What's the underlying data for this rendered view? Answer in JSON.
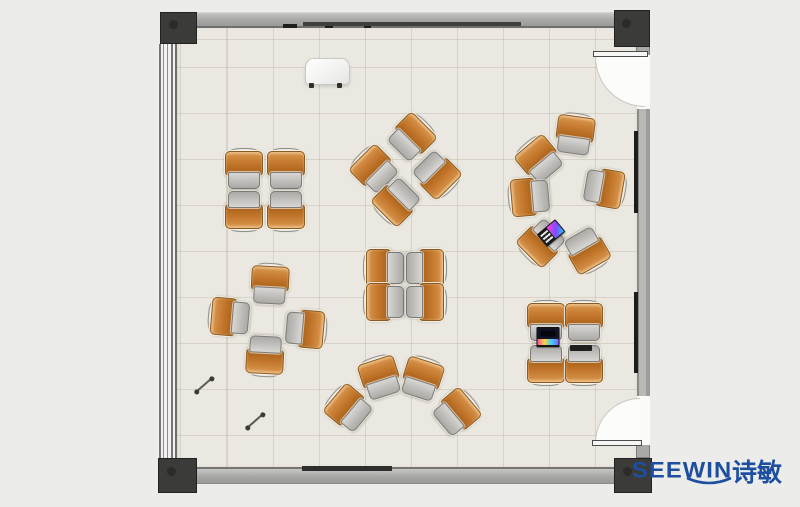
{
  "brand": {
    "latin": "SEEWIN",
    "cjk": "诗敏",
    "color": "#1d4e9f"
  },
  "palette": {
    "background": "#ececea",
    "floor": "#eae8e0",
    "floor_grid": "#d8d2c4",
    "wall": "#a6a6a4",
    "corner_post": "#3b3b39",
    "chair_seat_orange": "#c07429",
    "desk_tablet_gray": "#bdbbb7",
    "door_swing": "#fcfcfa",
    "laptop_screen_gradient": [
      "#ff3fd8",
      "#7c4dff",
      "#27c4ff"
    ]
  },
  "floorplan": {
    "description": "Top-view classroom floor plan with 30 tablet-arm chairs in 7 clusters, two doors on the right wall, window wall on the left, mobile whiteboard at top.",
    "clusters": [
      {
        "id": "top-left-quad",
        "units": [
          [
            244,
            169,
            0
          ],
          [
            286,
            169,
            0
          ],
          [
            244,
            211,
            180
          ],
          [
            286,
            211,
            180
          ]
        ]
      },
      {
        "id": "top-center-diamond",
        "units": [
          [
            374,
            169,
            -45
          ],
          [
            412,
            137,
            45
          ],
          [
            437,
            175,
            135
          ],
          [
            396,
            202,
            -135
          ]
        ]
      },
      {
        "id": "right-circle",
        "units": [
          [
            575,
            134,
            8
          ],
          [
            539,
            159,
            -40
          ],
          [
            529,
            197,
            -95
          ],
          [
            541,
            243,
            -135
          ],
          [
            605,
            188,
            100
          ],
          [
            587,
            251,
            150
          ]
        ]
      },
      {
        "id": "left-cross",
        "units": [
          [
            270,
            284,
            3
          ],
          [
            229,
            317,
            -85
          ],
          [
            306,
            329,
            95
          ],
          [
            265,
            356,
            183
          ]
        ]
      },
      {
        "id": "center-quad",
        "units": [
          [
            384,
            268,
            -90
          ],
          [
            426,
            268,
            90
          ],
          [
            384,
            302,
            -90
          ],
          [
            426,
            302,
            90
          ]
        ]
      },
      {
        "id": "bottom-fan",
        "units": [
          [
            348,
            408,
            -50
          ],
          [
            380,
            377,
            -18
          ],
          [
            422,
            378,
            18
          ],
          [
            457,
            412,
            50
          ]
        ]
      },
      {
        "id": "bottom-right-quad",
        "units": [
          [
            546,
            321,
            0
          ],
          [
            584,
            321,
            0
          ],
          [
            546,
            365,
            180
          ],
          [
            584,
            365,
            180
          ]
        ]
      }
    ],
    "accessories": [
      {
        "type": "laptop-angled",
        "x": 551,
        "y": 233,
        "rot": -40
      },
      {
        "type": "laptop",
        "x": 548,
        "y": 337,
        "rot": 0
      },
      {
        "type": "tablet",
        "x": 581,
        "y": 348,
        "rot": 0
      },
      {
        "type": "stick",
        "x": 204,
        "y": 385,
        "rot": -41
      },
      {
        "type": "stick",
        "x": 255,
        "y": 421,
        "rot": -41
      }
    ]
  }
}
